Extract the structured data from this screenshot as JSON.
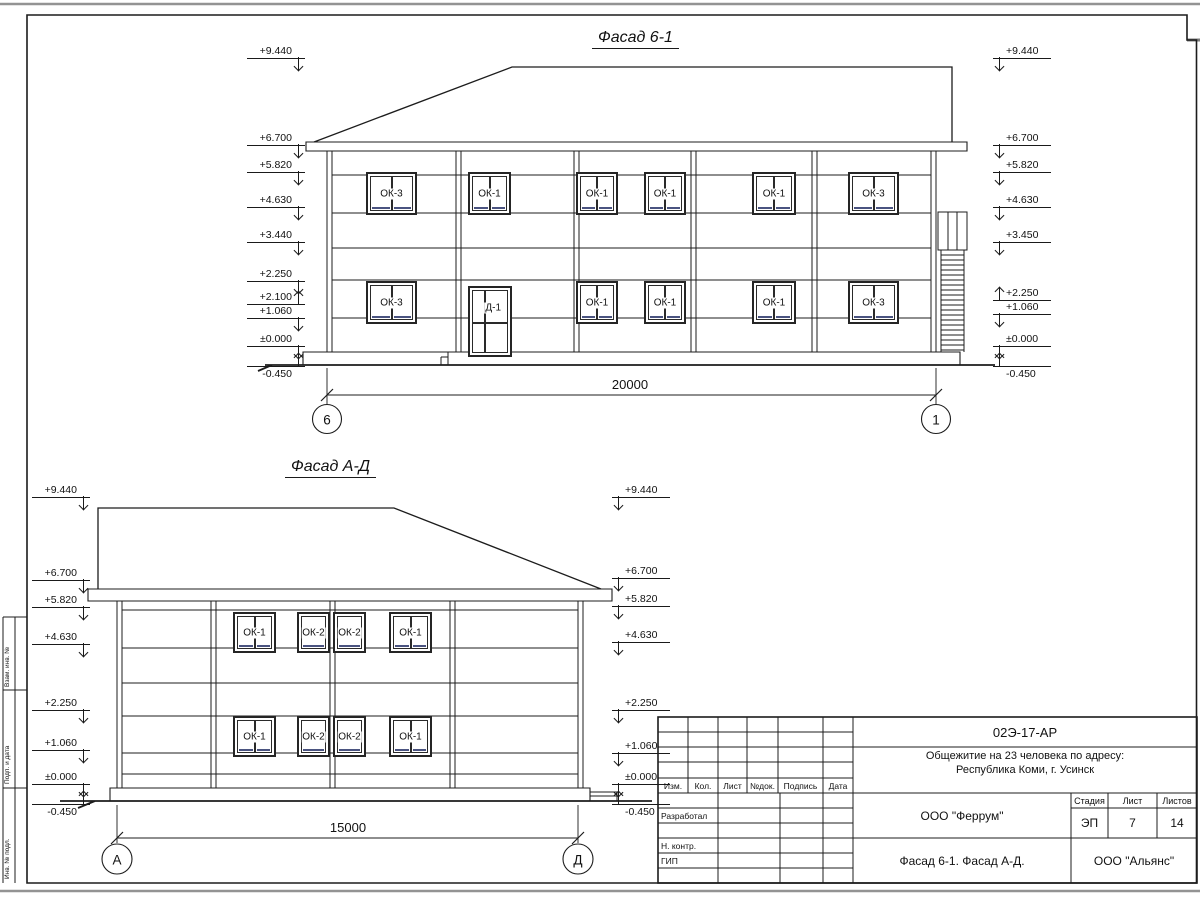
{
  "facade1": {
    "title": "Фасад 6-1",
    "dimension": "20000",
    "axis_left": "6",
    "axis_right": "1",
    "marks_left": [
      {
        "v": "+9.440",
        "y": 58,
        "dir": "down"
      },
      {
        "v": "+6.700",
        "y": 145,
        "dir": "down"
      },
      {
        "v": "+5.820",
        "y": 172,
        "dir": "down"
      },
      {
        "v": "+4.630",
        "y": 207,
        "dir": "down"
      },
      {
        "v": "+3.440",
        "y": 242,
        "dir": "down"
      },
      {
        "v": "+2.250",
        "y": 281,
        "dir": "down"
      },
      {
        "v": "+2.100",
        "y": 304,
        "dir": "up"
      },
      {
        "v": "+1.060",
        "y": 318,
        "dir": "down"
      },
      {
        "v": "±0.000",
        "y": 346,
        "dir": "down"
      },
      {
        "v": "-0.450",
        "y": 366,
        "dir": "up",
        "pos": "below"
      }
    ],
    "marks_right": [
      {
        "v": "+9.440",
        "y": 58,
        "dir": "down"
      },
      {
        "v": "+6.700",
        "y": 145,
        "dir": "down"
      },
      {
        "v": "+5.820",
        "y": 172,
        "dir": "down"
      },
      {
        "v": "+4.630",
        "y": 207,
        "dir": "down"
      },
      {
        "v": "+3.450",
        "y": 242,
        "dir": "down"
      },
      {
        "v": "+2.250",
        "y": 300,
        "dir": "up"
      },
      {
        "v": "+1.060",
        "y": 314,
        "dir": "down"
      },
      {
        "v": "±0.000",
        "y": 346,
        "dir": "down"
      },
      {
        "v": "-0.450",
        "y": 366,
        "dir": "up",
        "pos": "below"
      }
    ],
    "windows": [
      {
        "label": "ОК-3",
        "x": 366,
        "y": 172,
        "w": 51,
        "h": 43,
        "kind": "double"
      },
      {
        "label": "ОК-1",
        "x": 468,
        "y": 172,
        "w": 43,
        "h": 43,
        "kind": "double"
      },
      {
        "label": "ОК-1",
        "x": 576,
        "y": 172,
        "w": 42,
        "h": 43,
        "kind": "double"
      },
      {
        "label": "ОК-1",
        "x": 644,
        "y": 172,
        "w": 42,
        "h": 43,
        "kind": "double"
      },
      {
        "label": "ОК-1",
        "x": 752,
        "y": 172,
        "w": 44,
        "h": 43,
        "kind": "double"
      },
      {
        "label": "ОК-3",
        "x": 848,
        "y": 172,
        "w": 51,
        "h": 43,
        "kind": "double"
      },
      {
        "label": "ОК-3",
        "x": 366,
        "y": 281,
        "w": 51,
        "h": 43,
        "kind": "double"
      },
      {
        "label": "Д-1",
        "x": 468,
        "y": 286,
        "w": 44,
        "h": 71,
        "kind": "door"
      },
      {
        "label": "ОК-1",
        "x": 576,
        "y": 281,
        "w": 42,
        "h": 43,
        "kind": "double"
      },
      {
        "label": "ОК-1",
        "x": 644,
        "y": 281,
        "w": 42,
        "h": 43,
        "kind": "double"
      },
      {
        "label": "ОК-1",
        "x": 752,
        "y": 281,
        "w": 44,
        "h": 43,
        "kind": "double"
      },
      {
        "label": "ОК-3",
        "x": 848,
        "y": 281,
        "w": 51,
        "h": 43,
        "kind": "double"
      }
    ]
  },
  "facade2": {
    "title": "Фасад А-Д",
    "dimension": "15000",
    "axis_left": "А",
    "axis_right": "Д",
    "marks_left": [
      {
        "v": "+9.440",
        "y": 497,
        "dir": "down"
      },
      {
        "v": "+6.700",
        "y": 580,
        "dir": "down"
      },
      {
        "v": "+5.820",
        "y": 607,
        "dir": "down"
      },
      {
        "v": "+4.630",
        "y": 644,
        "dir": "down"
      },
      {
        "v": "+2.250",
        "y": 710,
        "dir": "down"
      },
      {
        "v": "+1.060",
        "y": 750,
        "dir": "down"
      },
      {
        "v": "±0.000",
        "y": 784,
        "dir": "down"
      },
      {
        "v": "-0.450",
        "y": 804,
        "dir": "up",
        "pos": "below"
      }
    ],
    "marks_right": [
      {
        "v": "+9.440",
        "y": 497,
        "dir": "down"
      },
      {
        "v": "+6.700",
        "y": 578,
        "dir": "down"
      },
      {
        "v": "+5.820",
        "y": 606,
        "dir": "down"
      },
      {
        "v": "+4.630",
        "y": 642,
        "dir": "down"
      },
      {
        "v": "+2.250",
        "y": 710,
        "dir": "down"
      },
      {
        "v": "+1.060",
        "y": 753,
        "dir": "down"
      },
      {
        "v": "±0.000",
        "y": 784,
        "dir": "down"
      },
      {
        "v": "-0.450",
        "y": 804,
        "dir": "up",
        "pos": "below"
      }
    ],
    "windows": [
      {
        "label": "ОК-1",
        "x": 233,
        "y": 612,
        "w": 43,
        "h": 41,
        "kind": "double"
      },
      {
        "label": "ОК-2",
        "x": 297,
        "y": 612,
        "w": 33,
        "h": 41,
        "kind": "single"
      },
      {
        "label": "ОК-2",
        "x": 333,
        "y": 612,
        "w": 33,
        "h": 41,
        "kind": "single"
      },
      {
        "label": "ОК-1",
        "x": 389,
        "y": 612,
        "w": 43,
        "h": 41,
        "kind": "double"
      },
      {
        "label": "ОК-1",
        "x": 233,
        "y": 716,
        "w": 43,
        "h": 41,
        "kind": "double"
      },
      {
        "label": "ОК-2",
        "x": 297,
        "y": 716,
        "w": 33,
        "h": 41,
        "kind": "single"
      },
      {
        "label": "ОК-2",
        "x": 333,
        "y": 716,
        "w": 33,
        "h": 41,
        "kind": "single"
      },
      {
        "label": "ОК-1",
        "x": 389,
        "y": 716,
        "w": 43,
        "h": 41,
        "kind": "double"
      }
    ]
  },
  "titleblock": {
    "doc_code": "02Э-17-АР",
    "project_line1": "Общежитие на 23 человека по адресу:",
    "project_line2": "Республика Коми, г. Усинск",
    "col_izm": "Изм.",
    "col_kol": "Кол.",
    "col_list": "Лист",
    "col_ndok": "№док.",
    "col_podpis": "Подпись",
    "col_data": "Дата",
    "role_1": "Разработал",
    "role_2": "Н. контр.",
    "role_3": "ГИП",
    "org": "ООО \"Феррум\"",
    "stage_label": "Стадия",
    "sheet_label": "Лист",
    "sheets_label": "Листов",
    "stage": "ЭП",
    "sheet_no": "7",
    "sheets_total": "14",
    "caption": "Фасад 6-1. Фасад  А-Д.",
    "org2": "ООО \"Альянс\""
  },
  "side_stamps": {
    "s1": "Взам. инв. №",
    "s2": "Подп. и дата",
    "s3": "Инв. № подл."
  }
}
